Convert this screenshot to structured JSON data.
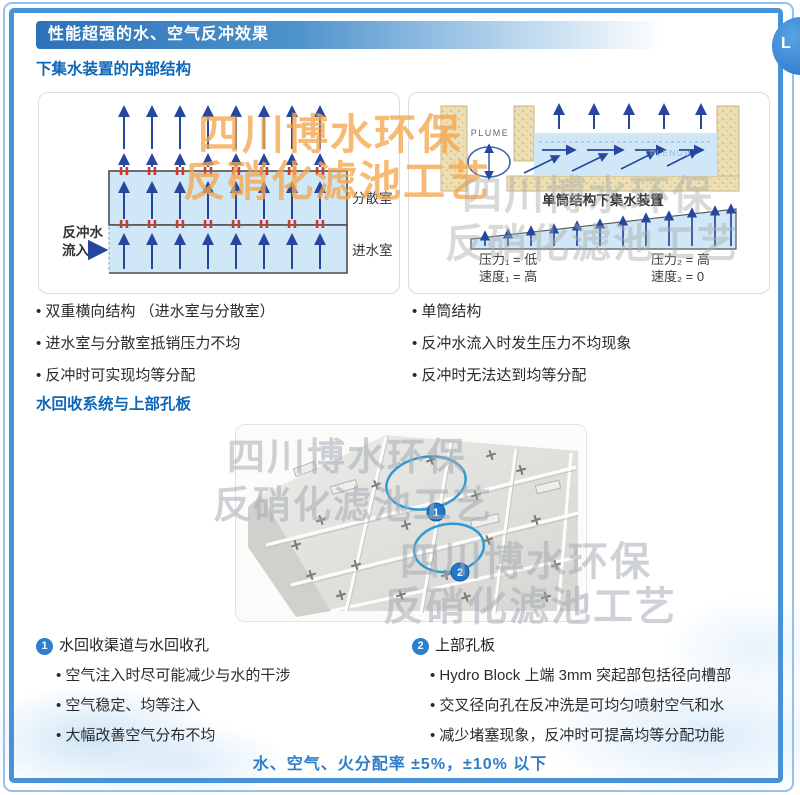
{
  "colors": {
    "accent_blue": "#2d72b8",
    "heading_blue": "#0e67b8",
    "frame_blue": "#4792d8",
    "arrow_blue": "#27479e",
    "water_fill": "#cfe7f7",
    "sand_fill": "#ecdfb6",
    "red_orifice": "#cc3b30",
    "watermark_orange": "#f3a64d",
    "annotation_blue": "#2f9ad2"
  },
  "header": {
    "title": "性能超强的水、空气反冲效果",
    "corner_badge": "L"
  },
  "watermark": {
    "line1": "四川博水环保",
    "line2": "反硝化滤池工艺"
  },
  "section_structure": {
    "heading": "下集水装置的内部结构",
    "dual_diagram": {
      "inflow_line1": "反冲水",
      "inflow_line2": "流入",
      "chamber_top": "分散室",
      "chamber_bottom": "进水室"
    },
    "single_diagram": {
      "plume": "PLUME",
      "plenum": "PLENUM",
      "caption": "单筒结构下集水装置",
      "pressure1": "压力₁ = 低",
      "velocity1": "速度₁ = 高",
      "pressure2": "压力₂ = 高",
      "velocity2": "速度₂ = 0"
    },
    "dual_bullets": [
      "双重横向结构 （进水室与分散室）",
      "进水室与分散室抵销压力不均",
      "反冲时可实现均等分配"
    ],
    "single_bullets": [
      "单筒结构",
      "反冲水流入时发生压力不均现象",
      "反冲时无法达到均等分配"
    ]
  },
  "section_recovery": {
    "heading": "水回收系统与上部孔板",
    "photo": {
      "annotation1": "1",
      "annotation2": "2"
    },
    "item1": {
      "number": "1",
      "title": "水回收渠道与水回收孔",
      "bullets": [
        "空气注入时尽可能减少与水的干涉",
        "空气稳定、均等注入",
        "大幅改善空气分布不均"
      ]
    },
    "item2": {
      "number": "2",
      "title": "上部孔板",
      "bullets": [
        "Hydro Block 上端 3mm 突起部包括径向槽部",
        "交叉径向孔在反冲洗是可均匀喷射空气和水",
        "减少堵塞现象，反冲时可提高均等分配功能"
      ]
    }
  },
  "footer": {
    "note": "水、空气、火分配率 ±5%，±10% 以下"
  }
}
